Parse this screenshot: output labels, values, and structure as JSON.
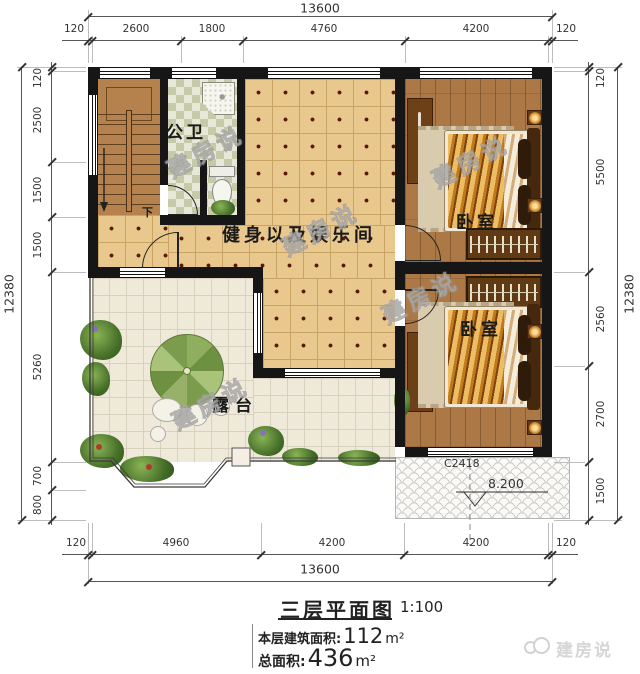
{
  "dimensions": {
    "top": {
      "overall": "13600",
      "segments": [
        "120",
        "2600",
        "1800",
        "4760",
        "4200",
        "120"
      ]
    },
    "bottom": {
      "overall": "13600",
      "segments": [
        "120",
        "4960",
        "4200",
        "4200",
        "120"
      ]
    },
    "left": {
      "overall": "12380",
      "segments": [
        "120",
        "2500",
        "1500",
        "1500",
        "5260",
        "700",
        "800"
      ]
    },
    "right": {
      "overall": "12380",
      "segments": [
        "120",
        "5500",
        "2560",
        "2700",
        "1500"
      ]
    }
  },
  "rooms": {
    "bathroom": "公卫",
    "gym": "健身以及娱乐间",
    "bedroom_top": "卧室",
    "bedroom_bottom": "卧室",
    "terrace": "露台",
    "stair_direction": "下"
  },
  "annotations": {
    "window_code": "C2418",
    "roof_elevation": "8.200"
  },
  "title_block": {
    "title": "三层平面图",
    "scale": "1:100",
    "floor_area_label": "本层建筑面积:",
    "floor_area_value": "112",
    "floor_area_unit": "m²",
    "total_area_label": "总面积:",
    "total_area_value": "436",
    "total_area_unit": "m²"
  },
  "brand": {
    "logo_text": "建房说",
    "watermark_text": "建房说"
  },
  "colors": {
    "wall": "#161616",
    "gym_floor": "#e9c88e",
    "terrace_floor": "#efe9da",
    "wood_floor": "#ab7846",
    "stair": "#b5824e",
    "bathroom_tile": "#c6caa8",
    "dimension_text": "#333333",
    "watermark": "#9a9a9a"
  }
}
